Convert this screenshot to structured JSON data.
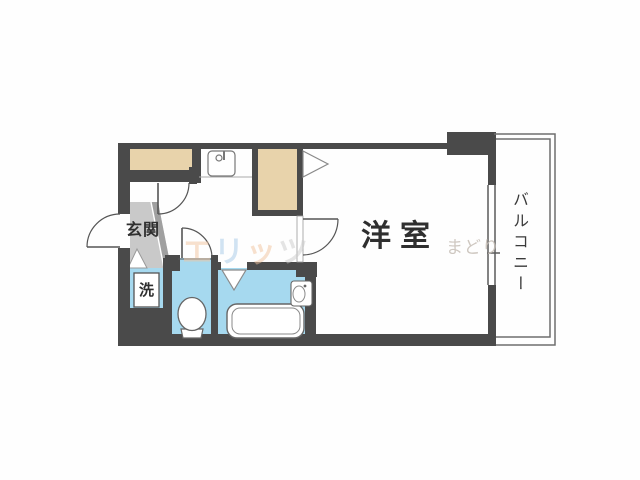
{
  "image": {
    "type": "apartment-floorplan",
    "width": 640,
    "height": 480
  },
  "floorplan": {
    "labels": {
      "entrance": "玄関",
      "washer": "洗",
      "western_room": "洋室",
      "balcony": "バルコニー"
    },
    "watermark": {
      "parts": [
        {
          "text": "エ",
          "color": "#f2c49e"
        },
        {
          "text": "リ",
          "color": "#a5c9e8"
        },
        {
          "text": "ッ",
          "color": "#f2c49e"
        },
        {
          "text": "ツ",
          "color": "#cbcbcb"
        }
      ],
      "secondary": "まどり"
    },
    "colors": {
      "wall": "#4a4a4a",
      "closet_fill": "#e8d3ab",
      "wet_area_fill": "#a6d9ef",
      "entrance_floor": "#c9c9c9",
      "entrance_step": "#a0a0a0",
      "outline": "#6e6e6e",
      "text": "#2f2f2f"
    },
    "fixtures": [
      "kitchen-sink",
      "washing-machine",
      "toilet",
      "bathtub",
      "wash-basin"
    ]
  }
}
